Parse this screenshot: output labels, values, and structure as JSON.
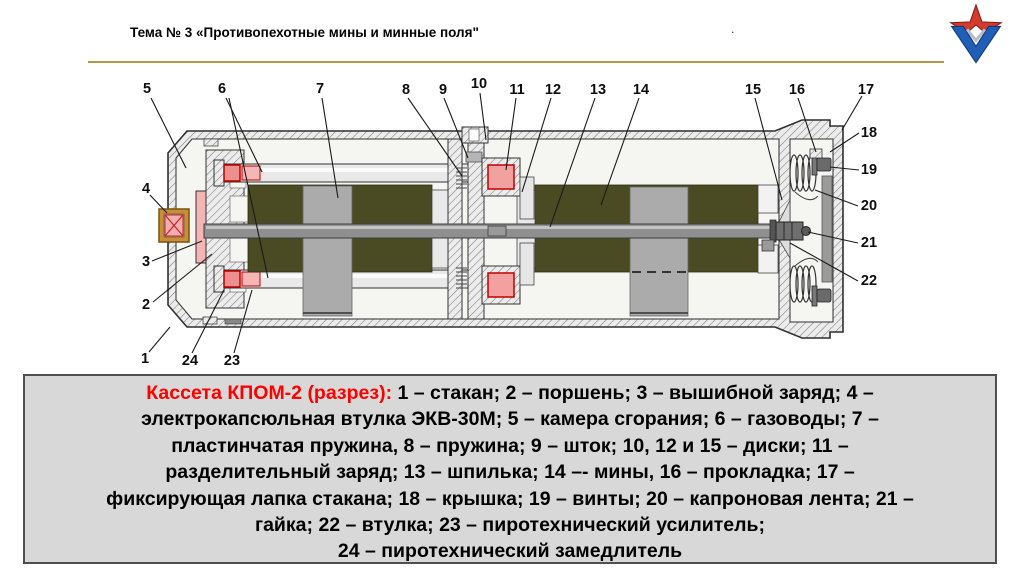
{
  "header": {
    "title": "Тема № 3 «Противопехотные мины и минные поля\"",
    "trailing_dot": ".",
    "rule_color": "#b2974b"
  },
  "logo": {
    "icon": "russian-army-star-icon",
    "red": "#d23b2e",
    "blue": "#1f5fb8"
  },
  "diagram": {
    "numbers": [
      "1",
      "2",
      "3",
      "4",
      "5",
      "6",
      "7",
      "8",
      "9",
      "10",
      "11",
      "12",
      "13",
      "14",
      "15",
      "16",
      "17",
      "18",
      "19",
      "20",
      "21",
      "22",
      "23",
      "24"
    ],
    "colors": {
      "casing": "#c9c9c9",
      "interior": "#f5f5f2",
      "mine_body": "#4a4a23",
      "charge_pink": "#f2a0a0",
      "charge_outline": "#c00000",
      "rod_gray": "#8f8f8f",
      "fitting_gold": "#c89036"
    }
  },
  "caption": {
    "lead": "Кассета КПОМ-2 (разрез):",
    "lines": [
      " 1 – стакан; 2 – поршень; 3  – вышибной заряд; 4 –",
      "электрокапсюльная втулка ЭКВ-30М; 5 – камера сгорания; 6 – газоводы; 7 –",
      "пластинчатая пружина, 8  – пружина; 9 – шток; 10, 12 и 15 – диски; 11 –",
      "разделительный заряд; 13  – шпилька; 14 –- мины, 16 – прокладка; 17 –",
      "фиксирующая лапка стакана; 18 – крышка; 19 – винты; 20  – капроновая лента; 21 –",
      "гайка; 22 – втулка; 23 – пиротехнический усилитель;",
      "24 – пиротехнический замедлитель"
    ]
  }
}
